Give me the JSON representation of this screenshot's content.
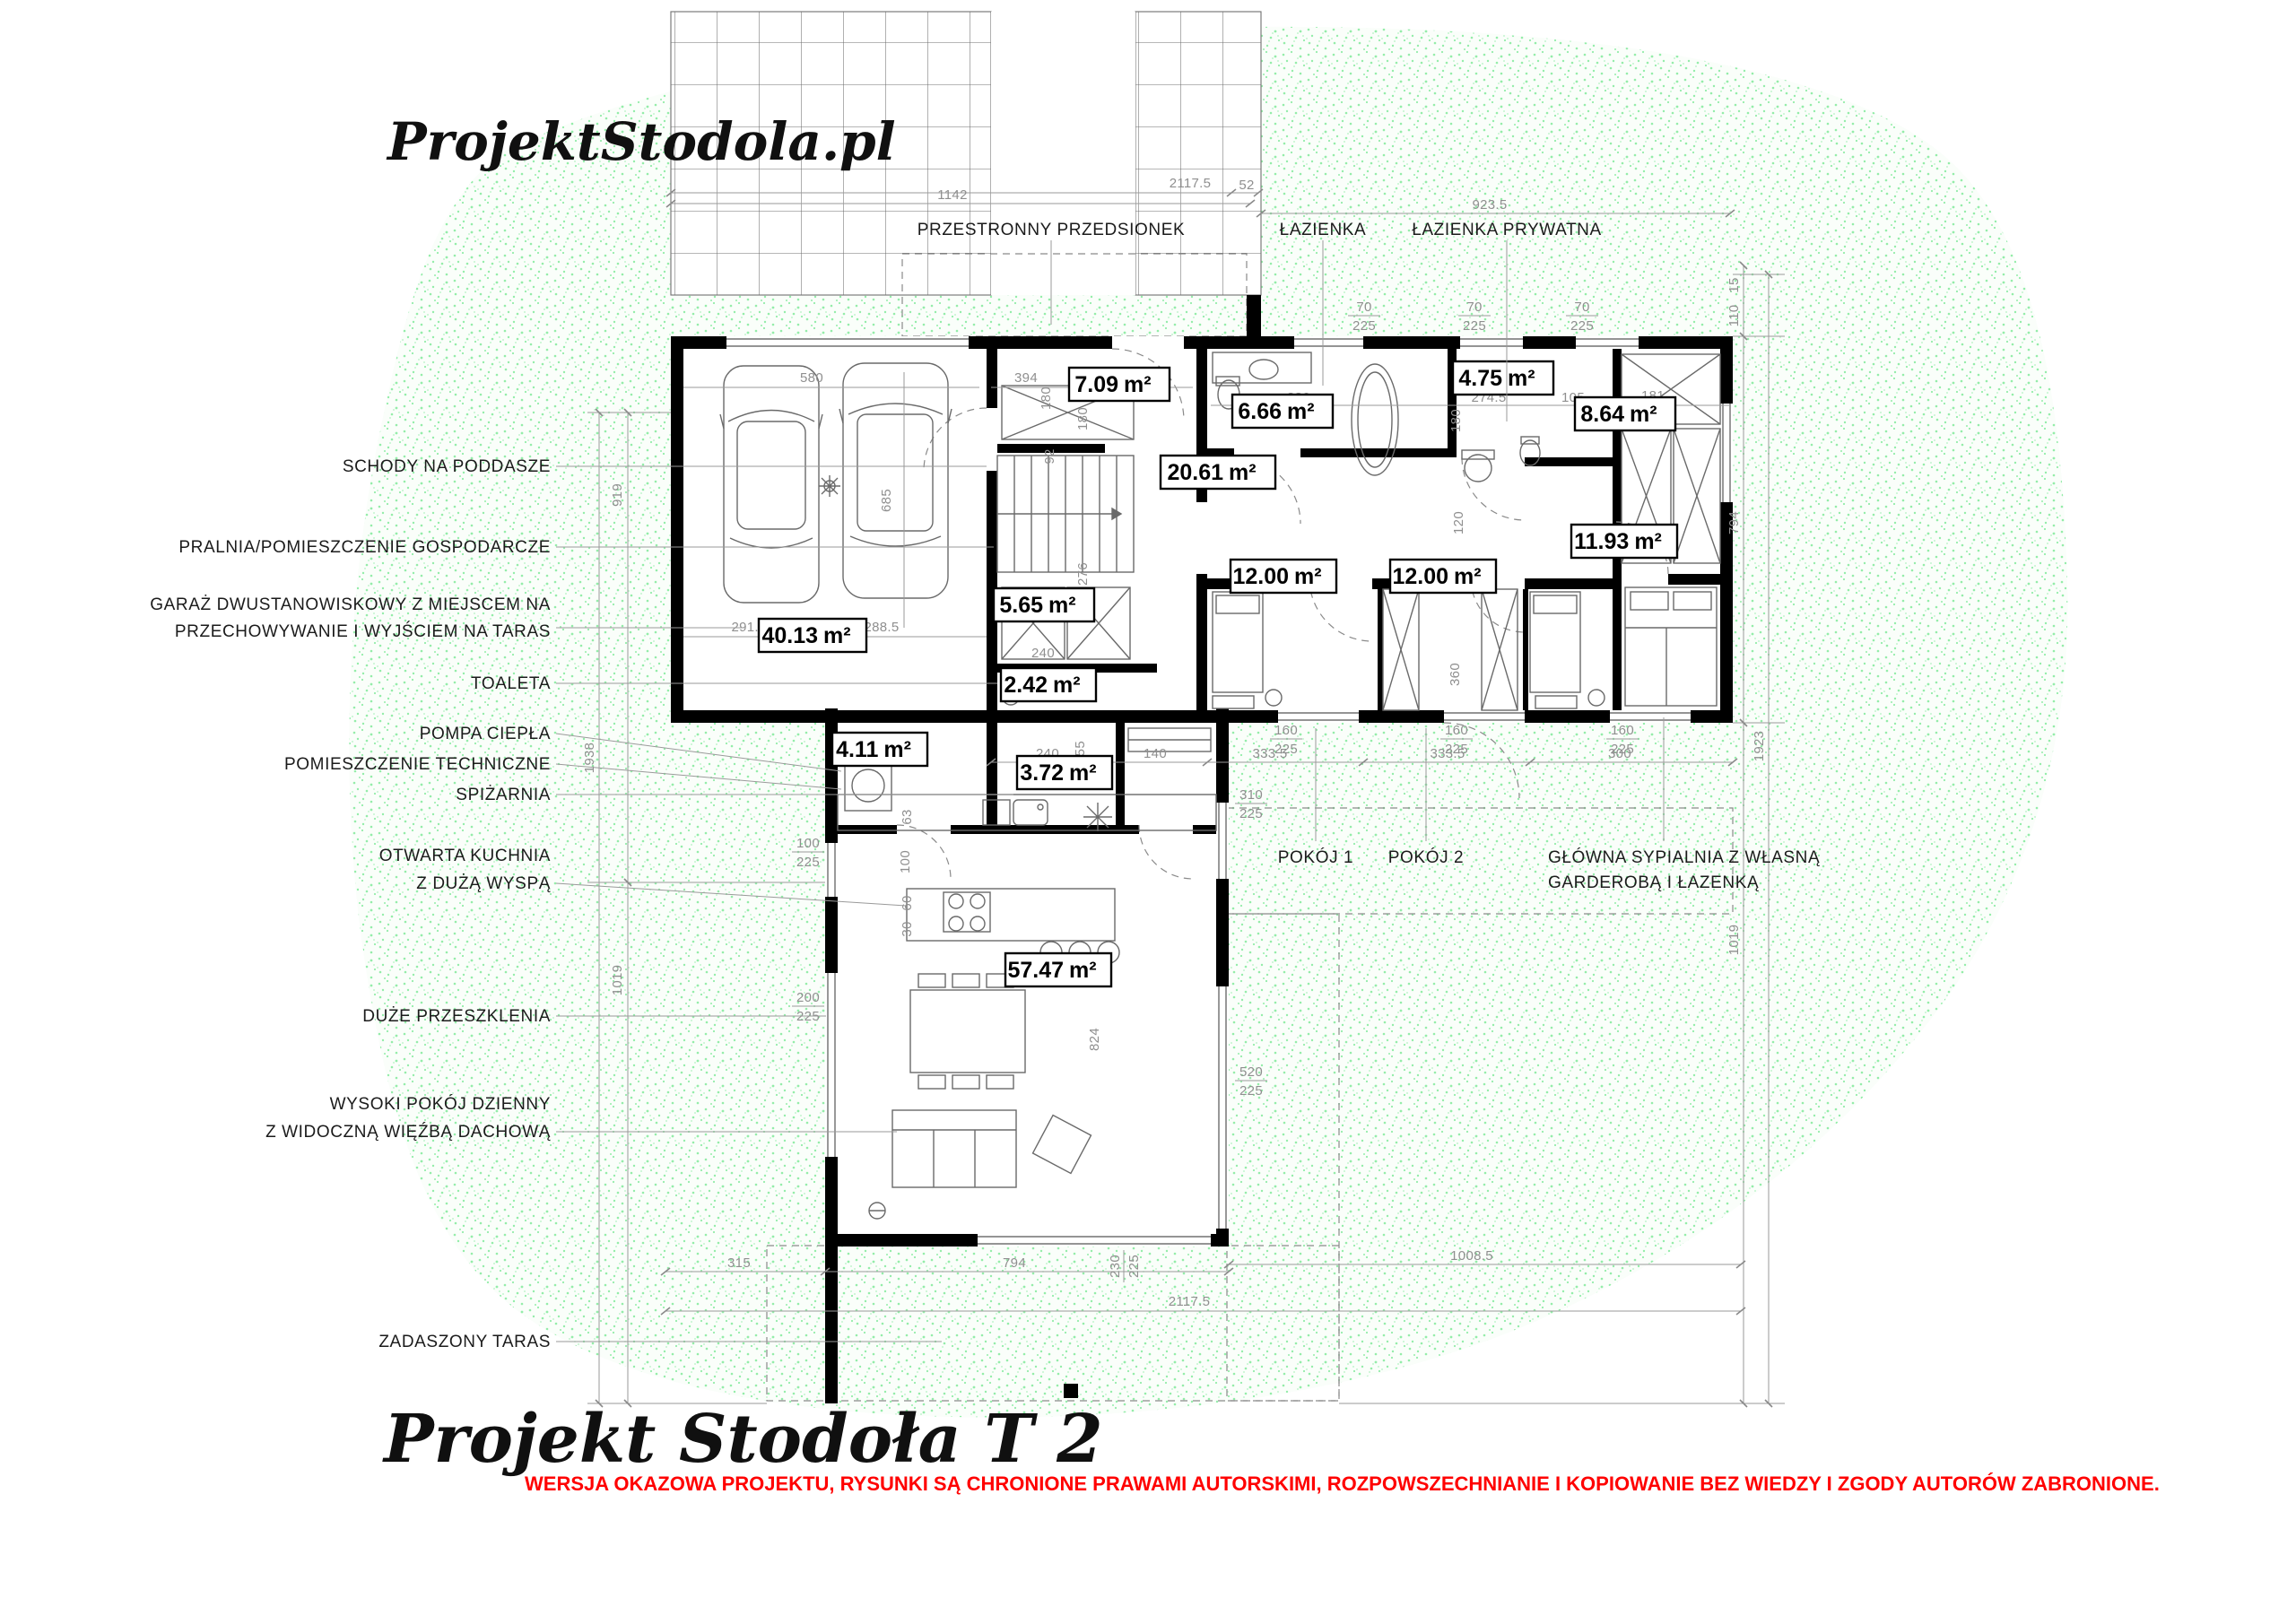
{
  "branding": {
    "logo": "ProjektStodola.pl",
    "title": "Projekt Stodoła T 2",
    "warning": "WERSJA OKAZOWA PROJEKTU, RYSUNKI  SĄ CHRONIONE PRAWAMI AUTORSKIMI, ROZPOWSZECHNIANIE I KOPIOWANIE BEZ WIEDZY I ZGODY AUTORÓW ZABRONIONE."
  },
  "colors": {
    "speckle_green": "#45e06b",
    "warning_red": "#ff0000",
    "wall_black": "#000000",
    "dim_gray": "#8f8f8f"
  },
  "unit": "m²",
  "areas": {
    "garage": "40.13",
    "vestibule": "7.09",
    "bath": "6.66",
    "bath_private": "4.75",
    "closet": "8.64",
    "hall": "20.61",
    "laundry": "5.65",
    "room1": "12.00",
    "room2": "12.00",
    "master": "11.93",
    "wc": "2.42",
    "tech": "4.11",
    "pantry": "3.72",
    "living": "57.47"
  },
  "labels": {
    "left": {
      "stairs": "SCHODY NA PODDASZE",
      "laundry": "PRALNIA/POMIESZCZENIE GOSPODARCZE",
      "garage1": "GARAŻ DWUSTANOWISKOWY Z MIEJSCEM NA",
      "garage2": "PRZECHOWYWANIE I WYJŚCIEM NA TARAS",
      "toilet": "TOALETA",
      "heat_pump": "POMPA CIEPŁA",
      "tech": "POMIESZCZENIE TECHNICZNE",
      "pantry": "SPIŻARNIA",
      "kitchen1": "OTWARTA KUCHNIA",
      "kitchen2": "Z DUŻĄ WYSPĄ",
      "glazing": "DUŻE PRZESZKLENIA",
      "living1": "WYSOKI POKÓJ DZIENNY",
      "living2": "Z WIDOCZNĄ WIĘŹBĄ DACHOWĄ",
      "terrace": "ZADASZONY TARAS"
    },
    "top": {
      "vestibule": "PRZESTRONNY PRZEDSIONEK",
      "bath": "ŁAZIENKA",
      "bath_private": "ŁAZIENKA PRYWATNA"
    },
    "rooms": {
      "room1": "POKÓJ 1",
      "room2": "POKÓJ 2",
      "master1": "GŁÓWNA SYPIALNIA Z WŁASNĄ",
      "master2": "GARDEROBĄ I ŁAZENKĄ"
    }
  },
  "dims": {
    "t1142": "1142",
    "t2117": "2117.5",
    "t52": "52",
    "t923": "923.5",
    "n70": "70",
    "n225": "225",
    "n160": "160",
    "n15": "15",
    "n110": "110",
    "n794": "794",
    "n1923": "1923",
    "n1019": "1019",
    "n919": "919",
    "n1938": "1938",
    "n315": "315",
    "n230": "230",
    "n1008": "1008.5",
    "n580": "580",
    "n394": "394",
    "n180": "180",
    "n685": "685",
    "n291": "291.5",
    "n288": "288.5",
    "n92": "92",
    "n276": "276",
    "n380": "380",
    "n274": "274.5",
    "n105": "105",
    "n181": "181",
    "n120": "120",
    "n240": "240",
    "n140": "140",
    "n333": "333.5",
    "n360": "360",
    "n300": "300",
    "n155": "155",
    "n63": "63",
    "n100": "100",
    "n60": "60",
    "n30": "30",
    "n310": "310",
    "n520": "520",
    "n200": "200",
    "n824": "824"
  }
}
